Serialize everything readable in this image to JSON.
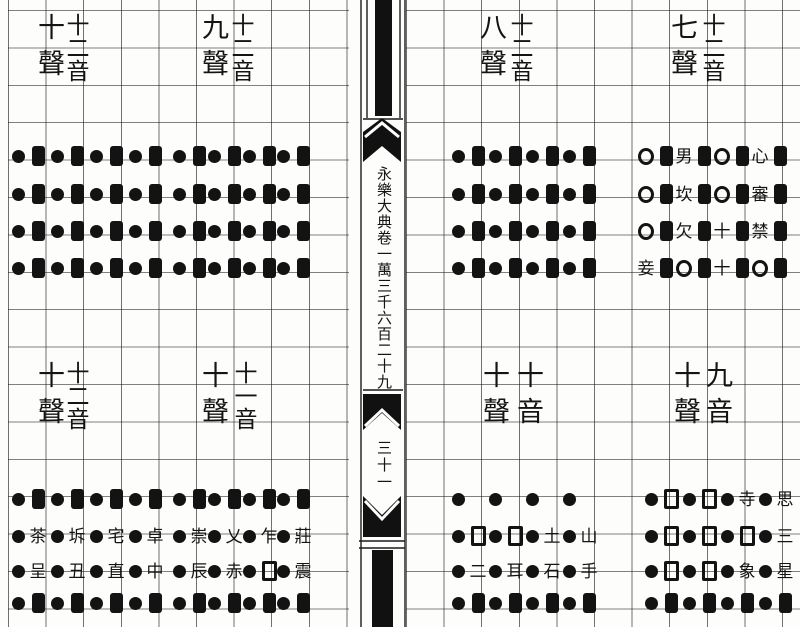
{
  "spine": {
    "volume_text": "永樂大典卷一萬三千六百二十九",
    "leaf_number": "三十一"
  },
  "symbol_types": {
    "dot": "filled-circle",
    "bar": "filled-rectangle",
    "ring": "open-circle",
    "sq": "open-square"
  },
  "sections": [
    {
      "id": "sheng-7",
      "sheng_label": "七聲",
      "yin_label": "十二音",
      "table": {
        "cols": [
          638,
          676,
          714,
          752
        ],
        "row_y": [
          143,
          181,
          218,
          255
        ],
        "rows": [
          [
            [
              "ring",
              "bar"
            ],
            [
              "男",
              "bar"
            ],
            [
              "ring",
              "bar"
            ],
            [
              "心",
              "bar"
            ]
          ],
          [
            [
              "ring",
              "bar"
            ],
            [
              "坎",
              "bar"
            ],
            [
              "ring",
              "bar"
            ],
            [
              "審",
              "bar"
            ]
          ],
          [
            [
              "ring",
              "bar"
            ],
            [
              "欠",
              "bar"
            ],
            [
              "十",
              "bar"
            ],
            [
              "禁",
              "bar"
            ]
          ],
          [
            [
              "妾",
              "bar"
            ],
            [
              "ring",
              "bar"
            ],
            [
              "十",
              "bar"
            ],
            [
              "ring",
              "bar"
            ]
          ]
        ]
      }
    },
    {
      "id": "sheng-8",
      "sheng_label": "八聲",
      "yin_label": "十二音",
      "table": {
        "cols": [
          450,
          487,
          524,
          561
        ],
        "row_y": [
          143,
          181,
          218,
          255
        ],
        "rows": [
          [
            [
              "dot",
              "bar"
            ],
            [
              "dot",
              "bar"
            ],
            [
              "dot",
              "bar"
            ],
            [
              "dot",
              "bar"
            ]
          ],
          [
            [
              "dot",
              "bar"
            ],
            [
              "dot",
              "bar"
            ],
            [
              "dot",
              "bar"
            ],
            [
              "dot",
              "bar"
            ]
          ],
          [
            [
              "dot",
              "bar"
            ],
            [
              "dot",
              "bar"
            ],
            [
              "dot",
              "bar"
            ],
            [
              "dot",
              "bar"
            ]
          ],
          [
            [
              "dot",
              "bar"
            ],
            [
              "dot",
              "bar"
            ],
            [
              "dot",
              "bar"
            ],
            [
              "dot",
              "bar"
            ]
          ]
        ]
      }
    },
    {
      "id": "sheng-9",
      "sheng_label": "九聲",
      "yin_label": "十二音",
      "table": {
        "cols": [
          171,
          206,
          241,
          275
        ],
        "row_y": [
          143,
          181,
          218,
          255
        ],
        "rows": [
          [
            [
              "dot",
              "bar"
            ],
            [
              "dot",
              "bar"
            ],
            [
              "dot",
              "bar"
            ],
            [
              "dot",
              "bar"
            ]
          ],
          [
            [
              "dot",
              "bar"
            ],
            [
              "dot",
              "bar"
            ],
            [
              "dot",
              "bar"
            ],
            [
              "dot",
              "bar"
            ]
          ],
          [
            [
              "dot",
              "bar"
            ],
            [
              "dot",
              "bar"
            ],
            [
              "dot",
              "bar"
            ],
            [
              "dot",
              "bar"
            ]
          ],
          [
            [
              "dot",
              "bar"
            ],
            [
              "dot",
              "bar"
            ],
            [
              "dot",
              "bar"
            ],
            [
              "dot",
              "bar"
            ]
          ]
        ]
      }
    },
    {
      "id": "sheng-10",
      "sheng_label": "十聲",
      "yin_label": "十二音",
      "table": {
        "cols": [
          10,
          49,
          88,
          127
        ],
        "row_y": [
          143,
          181,
          218,
          255
        ],
        "rows": [
          [
            [
              "dot",
              "bar"
            ],
            [
              "dot",
              "bar"
            ],
            [
              "dot",
              "bar"
            ],
            [
              "dot",
              "bar"
            ]
          ],
          [
            [
              "dot",
              "bar"
            ],
            [
              "dot",
              "bar"
            ],
            [
              "dot",
              "bar"
            ],
            [
              "dot",
              "bar"
            ]
          ],
          [
            [
              "dot",
              "bar"
            ],
            [
              "dot",
              "bar"
            ],
            [
              "dot",
              "bar"
            ],
            [
              "dot",
              "bar"
            ]
          ],
          [
            [
              "dot",
              "bar"
            ],
            [
              "dot",
              "bar"
            ],
            [
              "dot",
              "bar"
            ],
            [
              "dot",
              "bar"
            ]
          ]
        ]
      }
    },
    {
      "id": "yin-9",
      "sheng_label": "十聲",
      "yin_label": "九音",
      "table": {
        "cols": [
          643,
          681,
          719,
          757
        ],
        "row_y": [
          486,
          523,
          558,
          590
        ],
        "rows": [
          [
            [
              "dot",
              "sq"
            ],
            [
              "dot",
              "sq"
            ],
            [
              "dot",
              "寺"
            ],
            [
              "dot",
              "思"
            ]
          ],
          [
            [
              "dot",
              "sq"
            ],
            [
              "dot",
              "sq"
            ],
            [
              "dot",
              "sq"
            ],
            [
              "dot",
              "三"
            ]
          ],
          [
            [
              "dot",
              "sq"
            ],
            [
              "dot",
              "sq"
            ],
            [
              "dot",
              "象"
            ],
            [
              "dot",
              "星"
            ]
          ],
          [
            [
              "dot",
              "bar"
            ],
            [
              "dot",
              "bar"
            ],
            [
              "dot",
              "bar"
            ],
            [
              "dot",
              "bar"
            ]
          ]
        ]
      }
    },
    {
      "id": "yin-10",
      "sheng_label": "十聲",
      "yin_label": "十音",
      "table": {
        "cols": [
          450,
          487,
          524,
          561
        ],
        "row_y": [
          486,
          523,
          558,
          590
        ],
        "rows": [
          [
            [
              "dot",
              ""
            ],
            [
              "dot",
              ""
            ],
            [
              "dot",
              ""
            ],
            [
              "dot",
              ""
            ]
          ],
          [
            [
              "dot",
              "sq"
            ],
            [
              "dot",
              "sq"
            ],
            [
              "dot",
              "土"
            ],
            [
              "dot",
              "山"
            ]
          ],
          [
            [
              "dot",
              "二"
            ],
            [
              "dot",
              "耳"
            ],
            [
              "dot",
              "石"
            ],
            [
              "dot",
              "手"
            ]
          ],
          [
            [
              "dot",
              "bar"
            ],
            [
              "dot",
              "bar"
            ],
            [
              "dot",
              "bar"
            ],
            [
              "dot",
              "bar"
            ]
          ]
        ]
      }
    },
    {
      "id": "yin-11",
      "sheng_label": "十聲",
      "yin_label": "十一音",
      "table": {
        "cols": [
          171,
          206,
          241,
          275
        ],
        "row_y": [
          486,
          523,
          558,
          590
        ],
        "rows": [
          [
            [
              "dot",
              "bar"
            ],
            [
              "dot",
              "bar"
            ],
            [
              "dot",
              "bar"
            ],
            [
              "dot",
              "bar"
            ]
          ],
          [
            [
              "dot",
              "崇"
            ],
            [
              "dot",
              "乂"
            ],
            [
              "dot",
              "乍"
            ],
            [
              "dot",
              "莊"
            ]
          ],
          [
            [
              "dot",
              "辰"
            ],
            [
              "dot",
              "赤"
            ],
            [
              "dot",
              "sq"
            ],
            [
              "dot",
              "震"
            ]
          ],
          [
            [
              "dot",
              "bar"
            ],
            [
              "dot",
              "bar"
            ],
            [
              "dot",
              "bar"
            ],
            [
              "dot",
              "bar"
            ]
          ]
        ]
      }
    },
    {
      "id": "yin-12",
      "sheng_label": "十聲",
      "yin_label": "十二音",
      "table": {
        "cols": [
          10,
          49,
          88,
          127
        ],
        "row_y": [
          486,
          523,
          558,
          590
        ],
        "rows": [
          [
            [
              "dot",
              "bar"
            ],
            [
              "dot",
              "bar"
            ],
            [
              "dot",
              "bar"
            ],
            [
              "dot",
              "bar"
            ]
          ],
          [
            [
              "dot",
              "茶"
            ],
            [
              "dot",
              "坼"
            ],
            [
              "dot",
              "宅"
            ],
            [
              "dot",
              "卓"
            ]
          ],
          [
            [
              "dot",
              "呈"
            ],
            [
              "dot",
              "丑"
            ],
            [
              "dot",
              "直"
            ],
            [
              "dot",
              "中"
            ]
          ],
          [
            [
              "dot",
              "bar"
            ],
            [
              "dot",
              "bar"
            ],
            [
              "dot",
              "bar"
            ],
            [
              "dot",
              "bar"
            ]
          ]
        ]
      }
    }
  ]
}
